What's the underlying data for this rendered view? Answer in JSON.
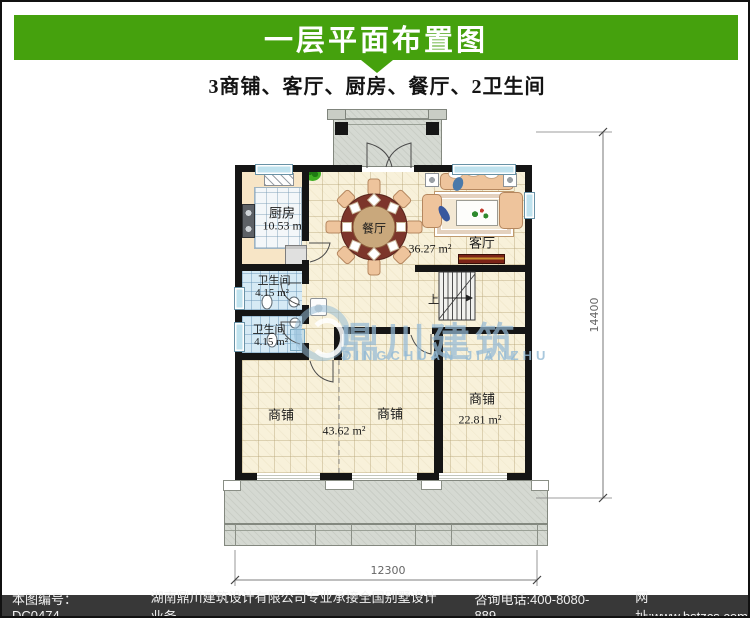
{
  "header": {
    "title": "一层平面布置图",
    "subtitle": "3商铺、客厅、厨房、餐厅、2卫生间"
  },
  "plan": {
    "rooms": {
      "kitchen": {
        "name": "厨房",
        "area": "10.53 m²"
      },
      "dining": {
        "name": "餐厅",
        "area": "36.27 m²"
      },
      "living": {
        "name": "客厅"
      },
      "bath1": {
        "name": "卫生间",
        "area": "4.15 m²"
      },
      "bath2": {
        "name": "卫生间",
        "area": "4.15 m²"
      },
      "shop_left": {
        "name": "商铺"
      },
      "shop_middle": {
        "name": "商铺",
        "area": "43.62 m²"
      },
      "shop_right": {
        "name": "商铺",
        "area": "22.81 m²"
      }
    },
    "stairs": {
      "up_label": "上"
    },
    "dimensions": {
      "right_vertical": "14400",
      "bottom_horizontal": "12300"
    }
  },
  "watermark": {
    "cn": "鼎川建筑",
    "en": "DINGCHUAN JIANZHU"
  },
  "footer": {
    "drawing_no": "本图编号：DC0474",
    "company": "湖南鼎川建筑设计有限公司专业承接全国别墅设计业务",
    "phone": "咨询电话:400-8080-889",
    "website": "网址:www.bstzcs.com"
  },
  "colors": {
    "accent_green": "#45a10d",
    "wall_black": "#151515",
    "floor_cream": "#f8f1da",
    "bath_tile_blue": "#d6eaf5",
    "watermark_blue": "#94bad5",
    "footer_bg": "#383838"
  }
}
